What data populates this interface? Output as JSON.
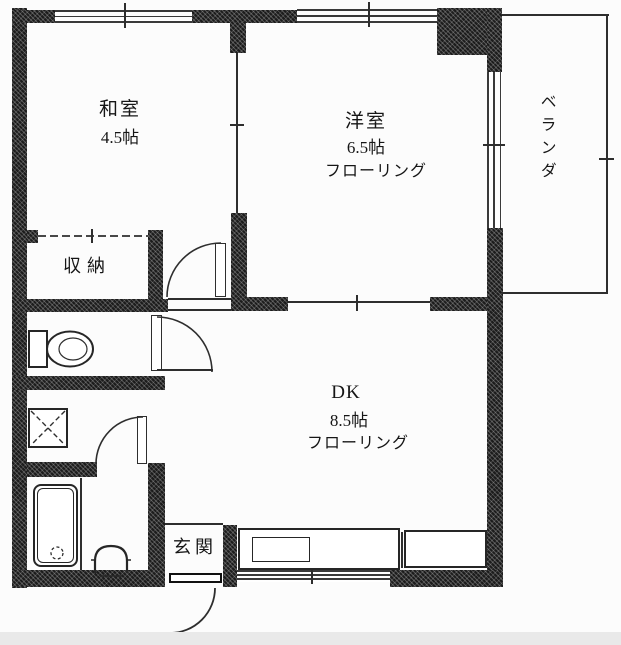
{
  "floorplan": {
    "background": "#fcfcfc",
    "wall_color": "#1c1c1c",
    "line_color": "#2e2e2e",
    "rooms": {
      "washitsu": {
        "name": "和室",
        "size": "4.5帖"
      },
      "youshitsu": {
        "name": "洋室",
        "size": "6.5帖",
        "flooring": "フローリング"
      },
      "dk": {
        "name": "DK",
        "size": "8.5帖",
        "flooring": "フローリング"
      },
      "closet": {
        "name": "収納"
      },
      "entrance": {
        "name": "玄関"
      },
      "veranda": {
        "name": "ベランダ"
      }
    },
    "fixtures": [
      "toilet-icon",
      "washing-machine-icon",
      "bathtub-icon",
      "washbasin-icon",
      "kitchen-counter",
      "kitchen-sink",
      "door-swing-icon",
      "window-icon"
    ]
  }
}
